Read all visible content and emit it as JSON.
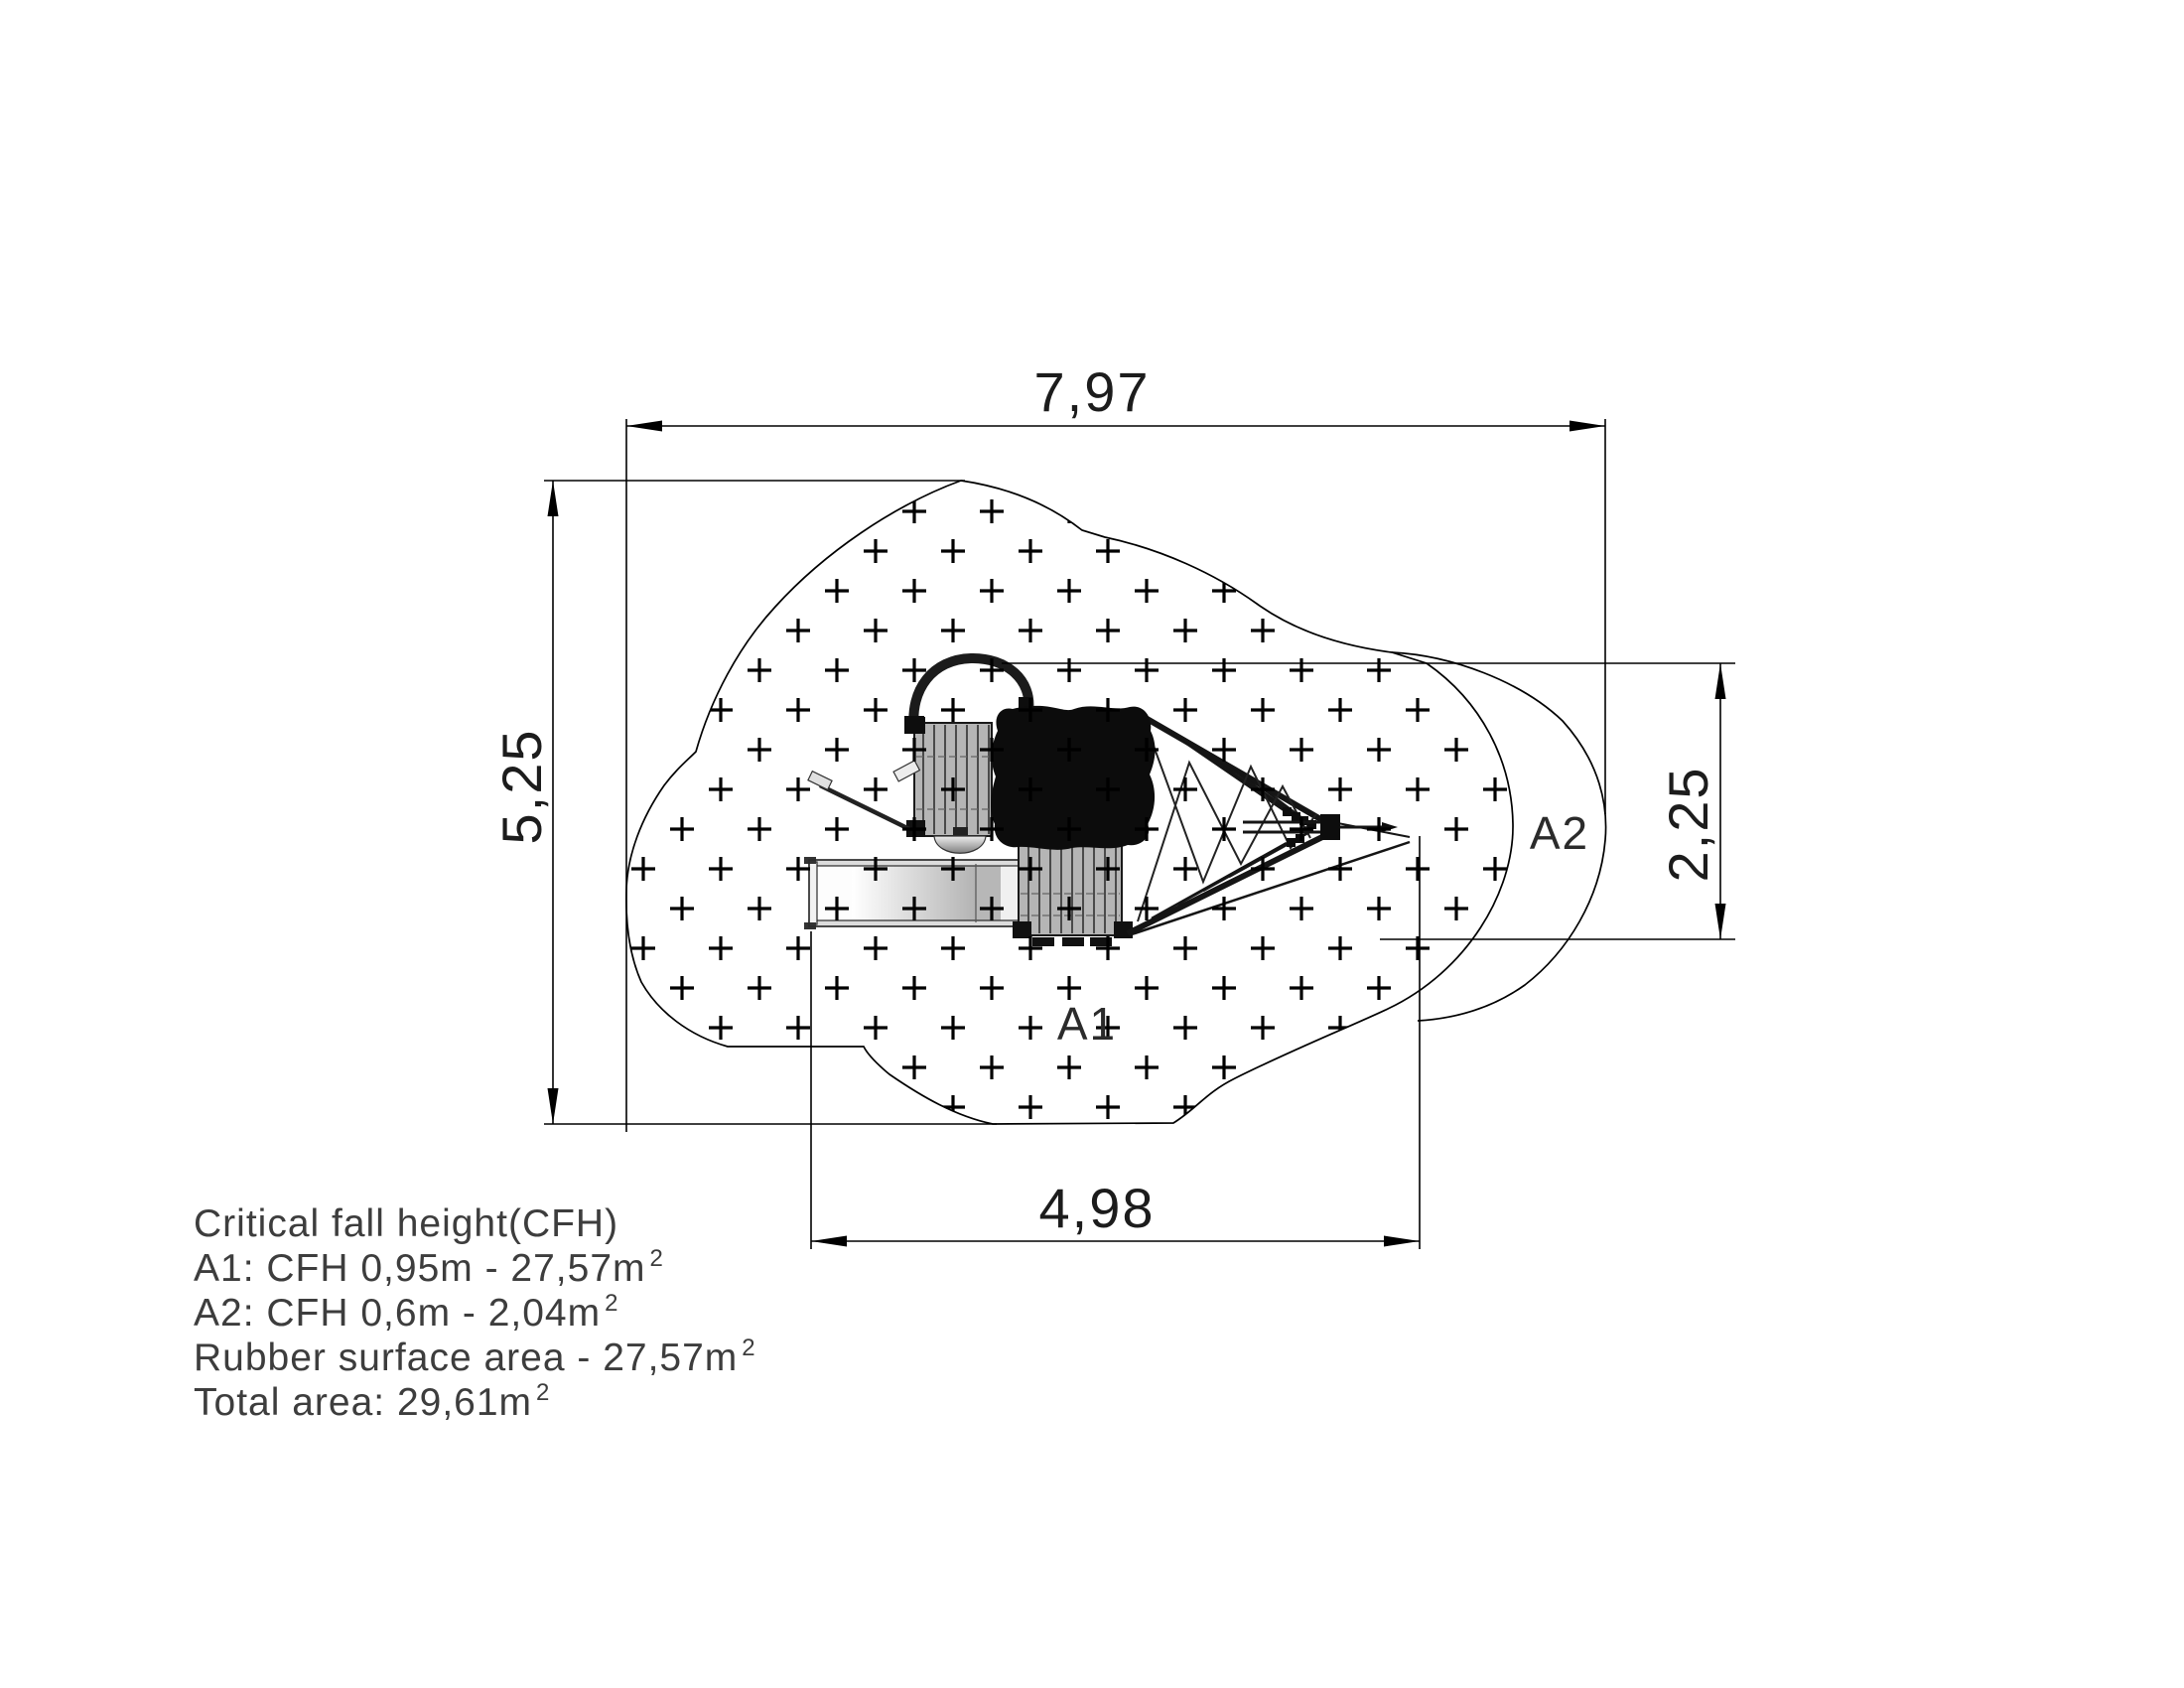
{
  "drawing": {
    "type": "playground-equipment-plan-view",
    "dimensions": {
      "top_width": "7,97",
      "left_height": "5,25",
      "right_height": "2,25",
      "bottom_width": "4,98"
    },
    "area_labels": {
      "a1": "A1",
      "a2": "A2"
    },
    "notes": {
      "line1": "Critical fall height(CFH)",
      "line2": "A1: CFH 0,95m - 27,57m",
      "line2_sup": "2",
      "line3": "A2: CFH 0,6m - 2,04m",
      "line3_sup": "2",
      "line4": "Rubber surface area - 27,57m",
      "line4_sup": "2",
      "line5": "Total area: 29,61m",
      "line5_sup": "2"
    },
    "colors": {
      "line": "#000000",
      "text": "#3d3d3d",
      "platform_grey": "#b5b5b5",
      "roof_black": "#0c0c0c",
      "canvas": "#ffffff"
    }
  }
}
